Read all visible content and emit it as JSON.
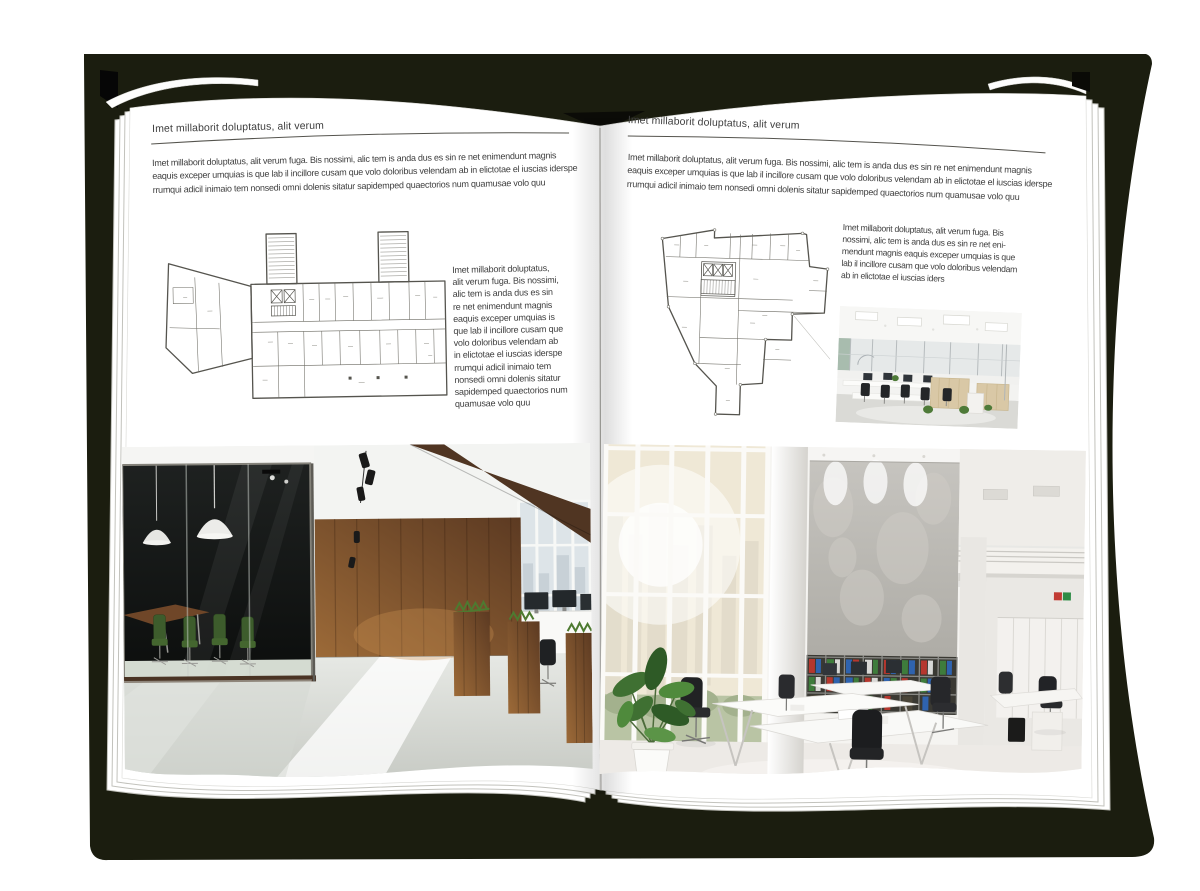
{
  "book": {
    "left_page": {
      "header": "Imet millaborit doluptatus, alit verum",
      "intro_lines": [
        "Imet millaborit doluptatus, alit verum fuga. Bis nossimi, alic tem is anda dus es sin re net enimendunt magnis",
        "eaquis exceper umquias is que lab il incillore cusam que volo doloribus velendam ab in elictotae el iuscias iderspe",
        "rrumqui adicil inimaio tem nonsedi omni dolenis sitatur sapidemped quaectorios num quamusae volo quu"
      ],
      "side_lines": [
        "Imet millaborit doluptatus,",
        "alit verum fuga. Bis nossimi,",
        "alic tem is anda dus es sin",
        "re net enimendunt magnis",
        "eaquis exceper umquias is",
        "que lab il incillore cusam que",
        "volo doloribus velendam ab",
        "in elictotae el iuscias iderspe",
        "rrumqui adicil inimaio tem",
        "nonsedi omni dolenis sitatur",
        "sapidemped quaectorios num",
        "quamusae volo quu"
      ],
      "floor_plan": "office-building-floor-plan-wide",
      "photo": "dark-wood-loft-office-interior"
    },
    "right_page": {
      "header": "Imet millaborit doluptatus, alit verum",
      "intro_lines": [
        "Imet millaborit doluptatus, alit verum fuga. Bis nossimi, alic tem is anda dus es sin re net enimendunt magnis",
        "eaquis exceper umquias is que lab il incillore cusam que volo doloribus velendam ab in elictotae el iuscias iderspe",
        "rrumqui adicil inimaio tem nonsedi omni dolenis sitatur sapidemped quaectorios num quamusae volo quu"
      ],
      "side_lines": [
        "Imet millaborit doluptatus, alit verum fuga. Bis",
        "nossimi, alic tem is anda dus es sin re net eni-",
        "mendunt magnis eaquis exceper umquias is que",
        "lab il incillore cusam que volo doloribus velendam",
        "ab in elictotae el iuscias iders"
      ],
      "floor_plan": "office-building-floor-plan-irregular",
      "photo_small": "white-open-plan-office-interior",
      "photo_large": "bright-atrium-office-interior"
    }
  },
  "colors": {
    "background": "#ffffff",
    "book_shadow": "#1b1d0f",
    "page": "#ffffff",
    "body_text": "#3f3f3f",
    "rule_line": "#55544e",
    "plan_line": "#55544e",
    "wood_brown": "#7c4e2a",
    "meeting_glass": "#161817",
    "chair_green": "#3d5c2c",
    "binder_red": "#b5372e",
    "binder_green": "#3e7c3c",
    "binder_blue": "#2f63ae",
    "concrete": "#bdbbb5"
  }
}
